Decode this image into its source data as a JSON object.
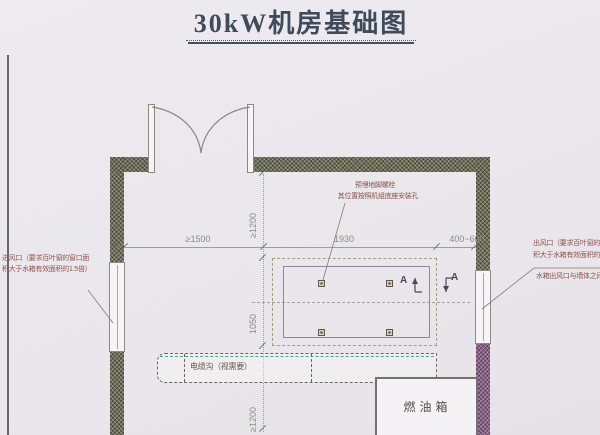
{
  "title": "30kW机房基础图",
  "dimensions": {
    "wall_to_pad_left": "≥1500",
    "pad_length": "1930",
    "pad_to_wall_right": "400~600",
    "wall_to_pad_top": "≥1200",
    "pad_width": "1050",
    "pad_to_bottom": "≥1200"
  },
  "annotations": {
    "anchor_bolt_line1": "预埋地脚螺栓",
    "anchor_bolt_line2": "其位置按照机组底座安装孔",
    "air_inlet_line1": "进风口（要求百叶窗的窗口面",
    "air_inlet_line2": "积大于水箱有效面积的1.5倍）",
    "air_outlet_line1": "出风口（要求百叶窗的窗",
    "air_outlet_line2": "积大于水箱有效面积的1",
    "air_outlet_line3": "水箱出风口与墙体之间"
  },
  "labels": {
    "cable_trench": "电缆沟（视需要）",
    "fuel_tank": "燃油箱",
    "section_marker": "A"
  },
  "colors": {
    "background": "#ebe9ed",
    "wall_hatch_olive": "#6f6e58",
    "wall_hatch_purple": "#8c6486",
    "dimension_line": "#7fae9c",
    "annotation_text": "#8b544c",
    "title_text": "#3f4b5a"
  }
}
